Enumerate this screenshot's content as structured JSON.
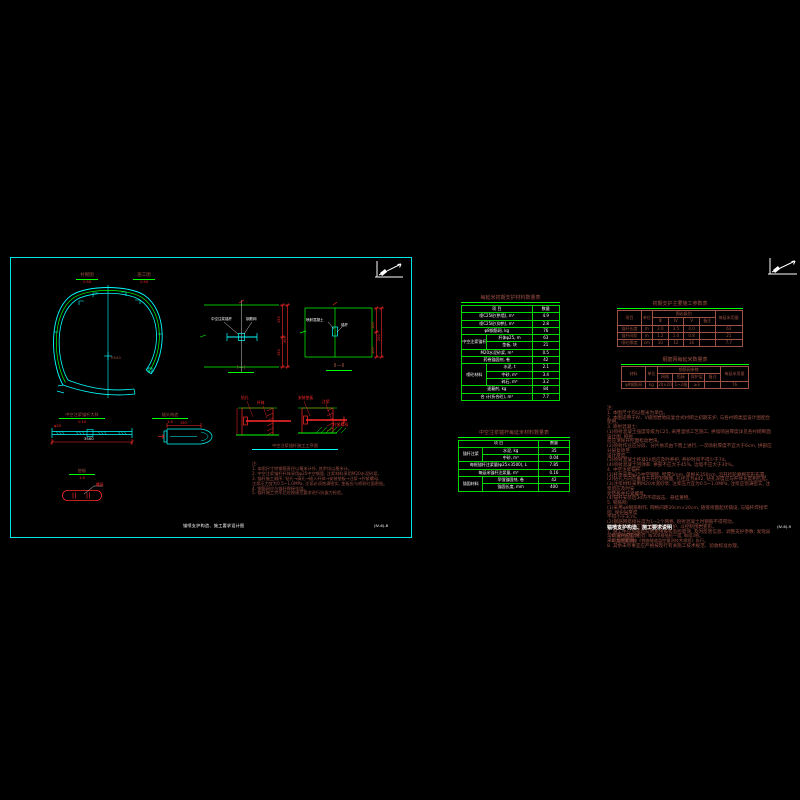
{
  "palette": {
    "cyan": "#00ffff",
    "green": "#00ff00",
    "red": "#ff2a2a",
    "brown": "#9e5144",
    "white": "#ffffff",
    "background": "#000000"
  },
  "left_sheet": {
    "half_labels": [
      {
        "label": "衬砌图",
        "scale": "1:50"
      },
      {
        "label": "施工图",
        "scale": "1:50"
      }
    ],
    "tunnel": {
      "radius_label": "R540"
    },
    "sections": [
      {
        "title": "Ⅰ—Ⅰ",
        "labels": [
          "中空注浆锚杆",
          "钢筋网"
        ],
        "dims": [
          "150",
          "150",
          "300"
        ]
      },
      {
        "title": "Ⅱ—Ⅱ",
        "labels": [
          "喷射混凝土",
          "锚杆"
        ],
        "dims": [
          "100",
          "100",
          "200"
        ]
      }
    ],
    "anchor_detail": {
      "title": "中空注浆锚杆大样",
      "scale": "1:10",
      "length_dim": "3500",
      "bar_label": "φ25"
    },
    "head_detail": {
      "title": "锚头构造",
      "scale": "1:5",
      "dim": "150"
    },
    "pad_detail": {
      "title": "垫板",
      "scale": "1:5",
      "label": "螺母"
    },
    "steps": {
      "title": "中空注浆锚杆施工工序图",
      "fig1_labels": [
        "钻孔",
        "杆体"
      ],
      "fig2_labels": [
        "安装垫板",
        "注浆",
        "拧紧螺母"
      ]
    },
    "notes": "注:\n1. 本图尺寸除钢筋直径以毫米计外, 其余均以厘米计。\n2. 中空注浆锚杆杆体采用φ25中空钢管, 注浆材料采用M20水泥砂浆。\n3. 锚杆施工顺序: 钻孔→清孔→插入杆体→安装垫板→注浆→拧紧螺母,\n    注浆压力宜为0.5~1.0MPa, 注浆必须饱满密实, 垫板应与喷射砼面密贴。\n4. 钢筋网应与锚杆焊接牢固。\n5. 锚杆施工完毕后应按规范要求进行抗拔力检验。",
    "title": "锚喷支护构造、施工要求设计图",
    "number": "(Ⅳ-6)-8"
  },
  "right_sheet": {
    "notes": "注:\n1. 本图尺寸均以厘米为单位。\n2. 本图适用于Ⅳ、Ⅴ级围岩地段复合式衬砌之初期支护, 与各衬砌类型设计图配合使用。\n3. 喷射混凝土:\n    (1)喷射混凝土强度等级为C25, 采用湿喷工艺施工, 拱墙喷层厚度详见各衬砌断面设计图, 喷射\n    前应清除开挖面松动岩块。\n    (2)喷射作业应分段、分片依次由下而上进行, 一次喷射厚度不宜大于6cm, 拱部应分层复喷至\n    设计厚度。\n    (3)喷射混凝土终凝2h后应及时养护, 养护时间不得少于7d。\n    (4)喷射混凝土回弹率: 拱部不应大于45%, 边墙不应大于30%。\n4. 中空注浆锚杆:\n    (1)杆体采用φ25中空钢管, 壁厚5mm, 单根长350cm, 沿开挖轮廓梅花形布置。\n    (2)钻孔方向应垂直于开挖轮廓面, 孔径宜为φ42, 钻孔深度应与杆体长度相匹配。\n    (3)注浆材料采用M20水泥砂浆, 注浆压力宜为0.5~1.0MPa, 注浆应饱满密实, 注浆后应及时安\n    装垫板并拧紧螺母。\n    (4)锚杆安装后3d内不得敲击、悬挂重物。\n5. 钢筋网:\n    (1)采用φ8钢筋制作, 网格间距20cm×20cm, 随受喷面起伏铺设, 与锚杆焊接牢固, 保护层厚度\n    不得小于3cm。\n    (2)钢筋网搭接长度为1~2个网格, 喷射混凝土时钢筋不得晃动。\n6. 隧道开挖后应及时施作初期支护, 以控制围岩变形。\n7. 施工中应加强超前地质预报和监控量测, 及时反馈信息、调整支护参数; 发现异常情况时应及时\n    采取加固措施。\n8. 其余未尽事宜应严格按现行有关施工技术规范、验收标准办理。",
    "footer_title": "锚喷支护构造、施工要求说明",
    "footer_notes": "① 锚杆抗拔力检验: 每300根抽检一组, 每组3根。\n② 监控量测按《铁路隧道监控量测技术规程》执行。",
    "number": "(Ⅳ-6)-9"
  },
  "tables": {
    "matA": {
      "title": "每延米初期支护材料数量表",
      "rows": [
        [
          {
            "t": "项  目",
            "cs": 2
          },
          {
            "t": "数量"
          }
        ],
        [
          {
            "t": "喷C25砼(拱墙), m³",
            "cs": 2
          },
          {
            "t": "4.9"
          }
        ],
        [
          {
            "t": "喷C25砼(仰拱), m³",
            "cs": 2
          },
          {
            "t": "2.8"
          }
        ],
        [
          {
            "t": "φ8钢筋网, kg",
            "cs": 2
          },
          {
            "t": "76"
          }
        ],
        [
          {
            "t": "中空注浆锚杆",
            "rs": 2
          },
          {
            "t": "杆体φ25, m"
          },
          {
            "t": "63"
          }
        ],
        [
          {
            "t": "垫板, 块"
          },
          {
            "t": "21"
          }
        ],
        [
          {
            "t": "M20水泥砂浆, m³",
            "cs": 2
          },
          {
            "t": "0.5"
          }
        ],
        [
          {
            "t": "药卷锚固剂, 卷",
            "cs": 2
          },
          {
            "t": "42"
          }
        ],
        [
          {
            "t": "喷砼材料",
            "rs": 3
          },
          {
            "t": "水泥, t"
          },
          {
            "t": "2.1"
          }
        ],
        [
          {
            "t": "中砂, m³"
          },
          {
            "t": "3.4"
          }
        ],
        [
          {
            "t": "碎石, m³"
          },
          {
            "t": "3.2"
          }
        ],
        [
          {
            "t": "速凝剂, kg",
            "cs": 2
          },
          {
            "t": "84"
          }
        ],
        [
          {
            "t": "合 计(折合砼), m³",
            "cs": 2
          },
          {
            "t": "7.7"
          }
        ]
      ]
    },
    "matB": {
      "title": "中空注浆锚杆每延米材料数量表",
      "rows": [
        [
          {
            "t": "项  目",
            "cs": 2
          },
          {
            "t": "数量"
          }
        ],
        [
          {
            "t": "锚杆注浆",
            "rs": 2
          },
          {
            "t": "水泥, kg"
          },
          {
            "t": "35"
          }
        ],
        [
          {
            "t": "中砂, m³"
          },
          {
            "t": "0.04"
          }
        ],
        [
          {
            "t": "每根锚杆注浆量(φ25×3500), L",
            "cs": 2
          },
          {
            "t": "7.85"
          }
        ],
        [
          {
            "t": "每延米锚杆注浆量, m³",
            "cs": 2
          },
          {
            "t": "0.16"
          }
        ],
        [
          {
            "t": "锚固材料",
            "rs": 2
          },
          {
            "t": "早强锚固剂, 卷"
          },
          {
            "t": "42"
          }
        ],
        [
          {
            "t": "锚固长度, mm"
          },
          {
            "t": "400"
          }
        ]
      ]
    },
    "paramC": {
      "title": "初期支护主要施工参数表",
      "rows": [
        [
          {
            "t": "项目",
            "rs": 2
          },
          {
            "t": "单位",
            "rs": 2
          },
          {
            "t": "围岩级别",
            "cs": 4
          },
          {
            "t": "每延米用量",
            "rs": 2
          }
        ],
        [
          {
            "t": "Ⅲ"
          },
          {
            "t": "Ⅳ"
          },
          {
            "t": "Ⅴ"
          },
          {
            "t": "备注"
          }
        ],
        [
          {
            "t": "锚杆长度"
          },
          {
            "t": "m"
          },
          {
            "t": "3.0"
          },
          {
            "t": "3.5"
          },
          {
            "t": "4.0"
          },
          {
            "t": ""
          },
          {
            "t": "63"
          }
        ],
        [
          {
            "t": "锚杆间距"
          },
          {
            "t": "m"
          },
          {
            "t": "1.2"
          },
          {
            "t": "1.0"
          },
          {
            "t": "0.8"
          },
          {
            "t": ""
          },
          {
            "t": "21"
          }
        ],
        [
          {
            "t": "喷砼厚度"
          },
          {
            "t": "cm"
          },
          {
            "t": "10"
          },
          {
            "t": "12"
          },
          {
            "t": "16"
          },
          {
            "t": ""
          },
          {
            "t": "7.7"
          }
        ]
      ]
    },
    "paramD": {
      "title": "钢筋网每延米数量表",
      "rows": [
        [
          {
            "t": "材料",
            "rs": 2
          },
          {
            "t": "单位",
            "rs": 2
          },
          {
            "t": "钢筋网参数",
            "cs": 4
          },
          {
            "t": "每延米用量",
            "rs": 2
          }
        ],
        [
          {
            "t": "网格"
          },
          {
            "t": "搭接"
          },
          {
            "t": "保护层"
          },
          {
            "t": "备注"
          }
        ],
        [
          {
            "t": "φ8钢筋网"
          },
          {
            "t": "kg"
          },
          {
            "t": "20×20"
          },
          {
            "t": "1~2格"
          },
          {
            "t": "≥3"
          },
          {
            "t": ""
          },
          {
            "t": "76"
          }
        ]
      ]
    }
  }
}
